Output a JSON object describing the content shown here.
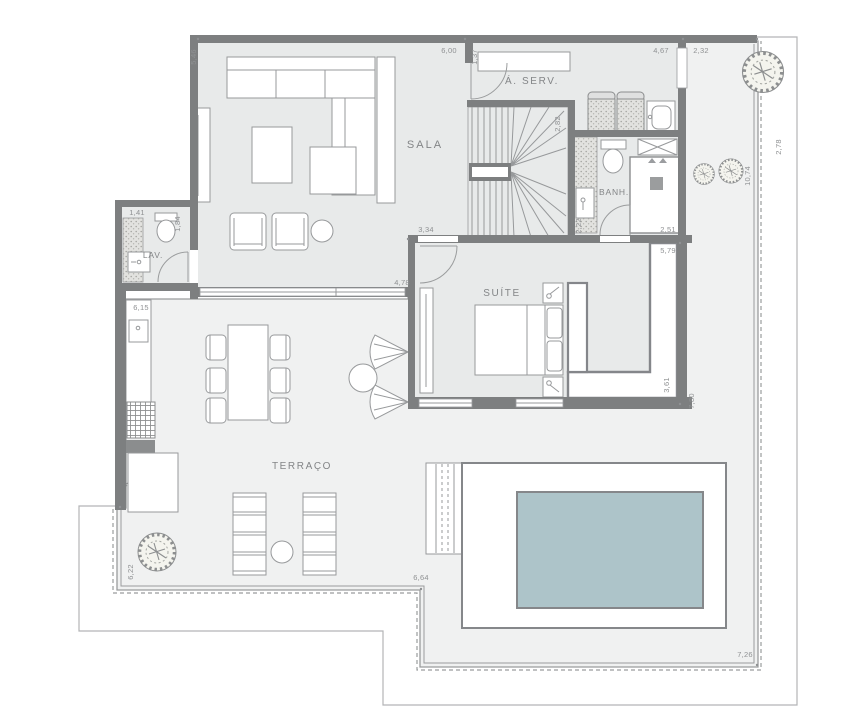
{
  "drawing": {
    "type": "apartment floor plan with terrace and pool"
  },
  "colors": {
    "wall": "#7d7f80",
    "room_floor": "#e8eaea",
    "terrace_floor": "#f0f1f1",
    "pool_water": "#adc4c9",
    "line": "#9a9c9d",
    "dim_text": "#8f9193",
    "label_text": "#838587"
  },
  "rooms": {
    "sala": {
      "label": "SALA"
    },
    "aserv": {
      "label": "Á. SERV."
    },
    "banh": {
      "label": "BANH."
    },
    "lav": {
      "label": "LAV."
    },
    "suite": {
      "label": "SUÍTE"
    },
    "terraco": {
      "label": "TERRAÇO"
    }
  },
  "dims": {
    "d546": "5,46",
    "d600": "6,00",
    "d137": "1,37",
    "d467": "4,67",
    "d232": "2,32",
    "d278": "2,78",
    "d1074": "10,74",
    "d282": "2,82",
    "d222": "2,22",
    "d251": "2,51",
    "d334": "3,34",
    "d579": "5,79",
    "d361": "3,61",
    "d780": "7,80",
    "d478": "4,78",
    "d141": "1,41",
    "d184": "1,84",
    "d615": "6,15",
    "d622": "6,22",
    "d664": "6,64",
    "d726": "7,26"
  }
}
